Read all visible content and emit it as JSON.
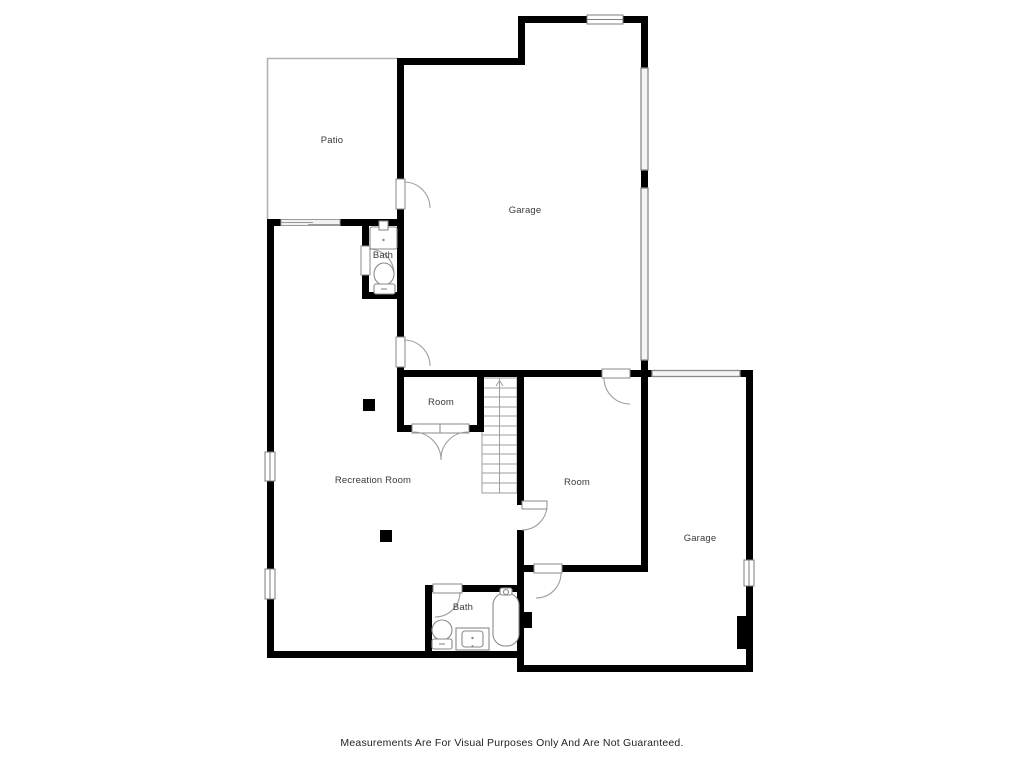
{
  "disclaimer": "Measurements Are For Visual Purposes Only And Are Not Guaranteed.",
  "rooms": [
    {
      "label": "Patio"
    },
    {
      "label": "Garage"
    },
    {
      "label": "Bath"
    },
    {
      "label": "Room"
    },
    {
      "label": "Recreation Room"
    },
    {
      "label": "Room"
    },
    {
      "label": "Garage"
    },
    {
      "label": "Bath"
    }
  ],
  "colors": {
    "wall": "#000000",
    "background": "#ffffff",
    "outdoor_outline": "#b3b3b3",
    "door_window_stroke": "#8a8a8a",
    "label_text": "#3a3a3a",
    "disclaimer_text": "#1f1f1f"
  }
}
